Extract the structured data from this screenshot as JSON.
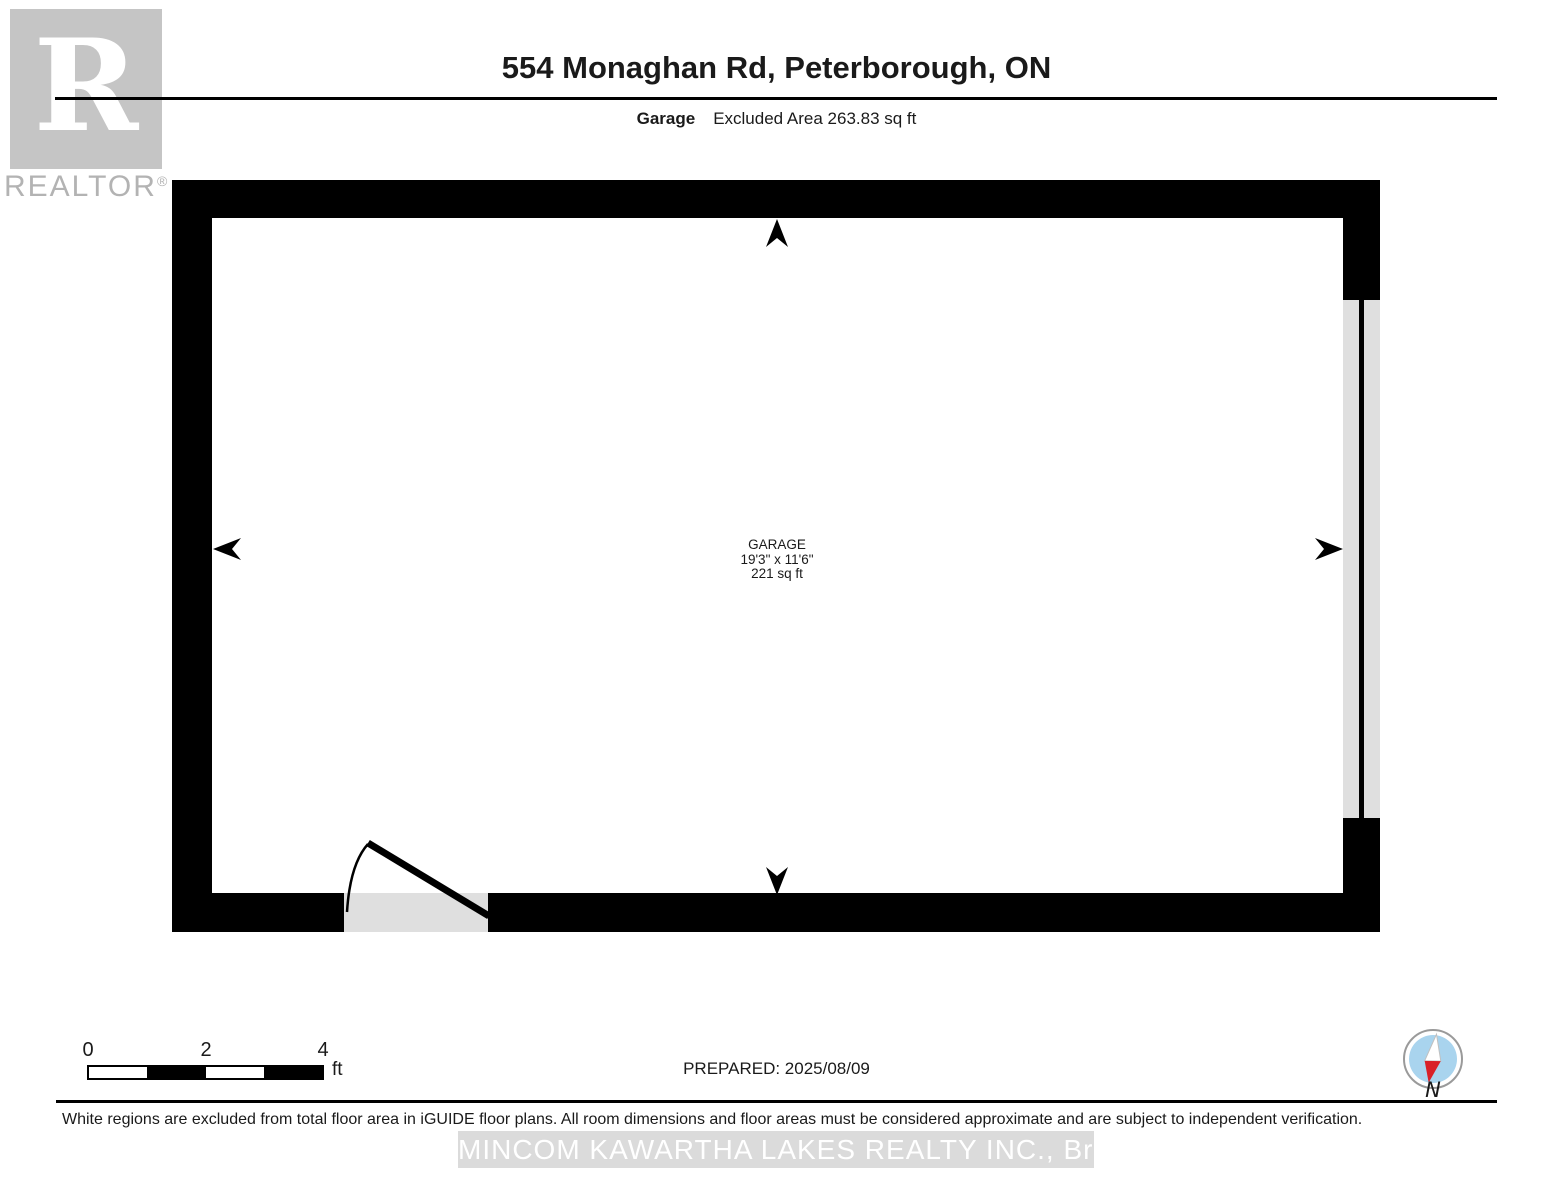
{
  "logo": {
    "letter": "R",
    "wordmark": "REALTOR",
    "registered": "®"
  },
  "header": {
    "title": "554 Monaghan Rd, Peterborough, ON",
    "floor_label": "Garage",
    "excluded_area_label": "Excluded Area 263.83 sq ft"
  },
  "room": {
    "name": "GARAGE",
    "dimensions": "19'3\" x 11'6\"",
    "area": "221 sq ft"
  },
  "scale_bar": {
    "ticks": [
      "0",
      "2",
      "4"
    ],
    "unit": "ft"
  },
  "footer": {
    "prepared": "PREPARED: 2025/08/09",
    "compass_label": "N",
    "disclaimer": "White regions are excluded from total floor area in iGUIDE floor plans. All room dimensions and floor areas must be considered approximate and are subject to independent verification.",
    "watermark": "MINCOM KAWARTHA LAKES REALTY INC., Brokerage"
  },
  "colors": {
    "wall": "#000000",
    "opening_fill": "#dfdfdf",
    "logo_gray": "#c5c5c5",
    "logo_text_gray": "#b3b3b3",
    "compass_blue": "#a9d4ee",
    "compass_red": "#d92027",
    "watermark_bg": "#dbdbdb",
    "watermark_text": "#ffffff"
  }
}
